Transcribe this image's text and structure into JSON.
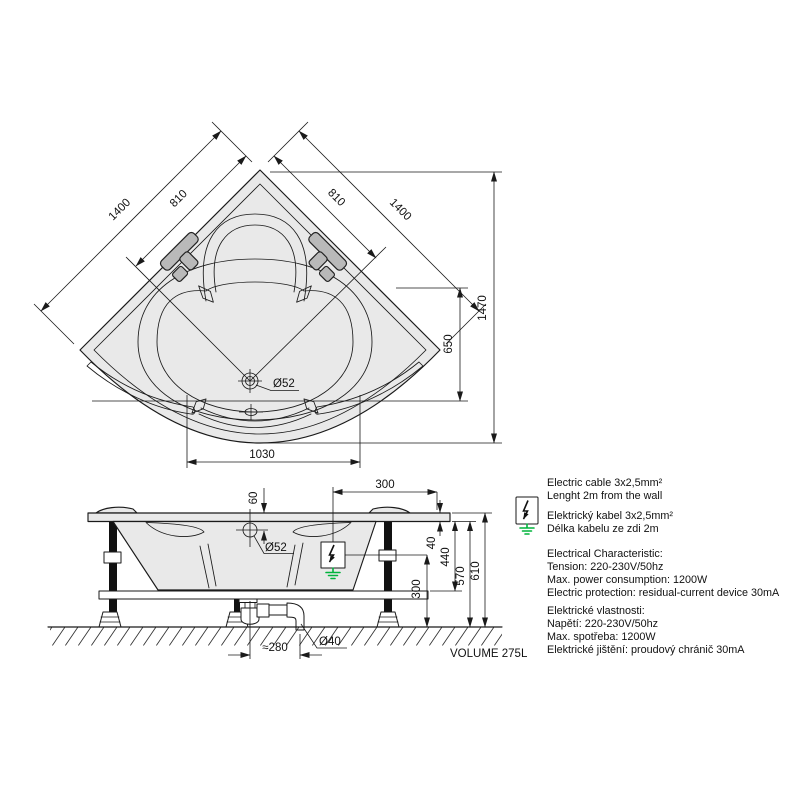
{
  "top_view": {
    "dim_side_left": "1400",
    "dim_seat_left": "810",
    "dim_seat_right": "810",
    "dim_side_right": "1400",
    "dim_depth": "1470",
    "dim_bowl_depth": "650",
    "dim_front_width": "1030",
    "drain_dia": "Ø52"
  },
  "side_view": {
    "dim_overflow_offset": "60",
    "dim_cable_from_wall": "300",
    "overflow_dia": "Ø52",
    "dim_rim_thickness": "40",
    "dim_cable_height": "440",
    "dim_floor_clearance": "300",
    "dim_height_under_rim": "570",
    "dim_total_height": "610",
    "dim_trap_offset": "≈280",
    "waste_pipe_dia": "Ø40",
    "volume_label": "VOLUME 275L"
  },
  "notes": {
    "cable_en_1": "Electric cable 3x2,5mm²",
    "cable_en_2": "Lenght 2m from the wall",
    "cable_cz_1": "Elektrický kabel 3x2,5mm²",
    "cable_cz_2": "Délka kabelu ze zdi 2m",
    "elec_en_title": "Electrical Characteristic:",
    "elec_en_1": "Tension: 220-230V/50hz",
    "elec_en_2": "Max. power consumption: 1200W",
    "elec_en_3": "Electric protection: residual-current device 30mA",
    "elec_cz_title": "Elektrické vlastnosti:",
    "elec_cz_1": "Napětí: 220-230V/50hz",
    "elec_cz_2": "Max. spotřeba: 1200W",
    "elec_cz_3": "Elektrické jištění: proudový chránič 30mA"
  },
  "colors": {
    "line": "#1a1a1a",
    "fill_light": "#e9e9e9",
    "handle": "#b9b9b9",
    "ground_green": "#00b33c"
  }
}
